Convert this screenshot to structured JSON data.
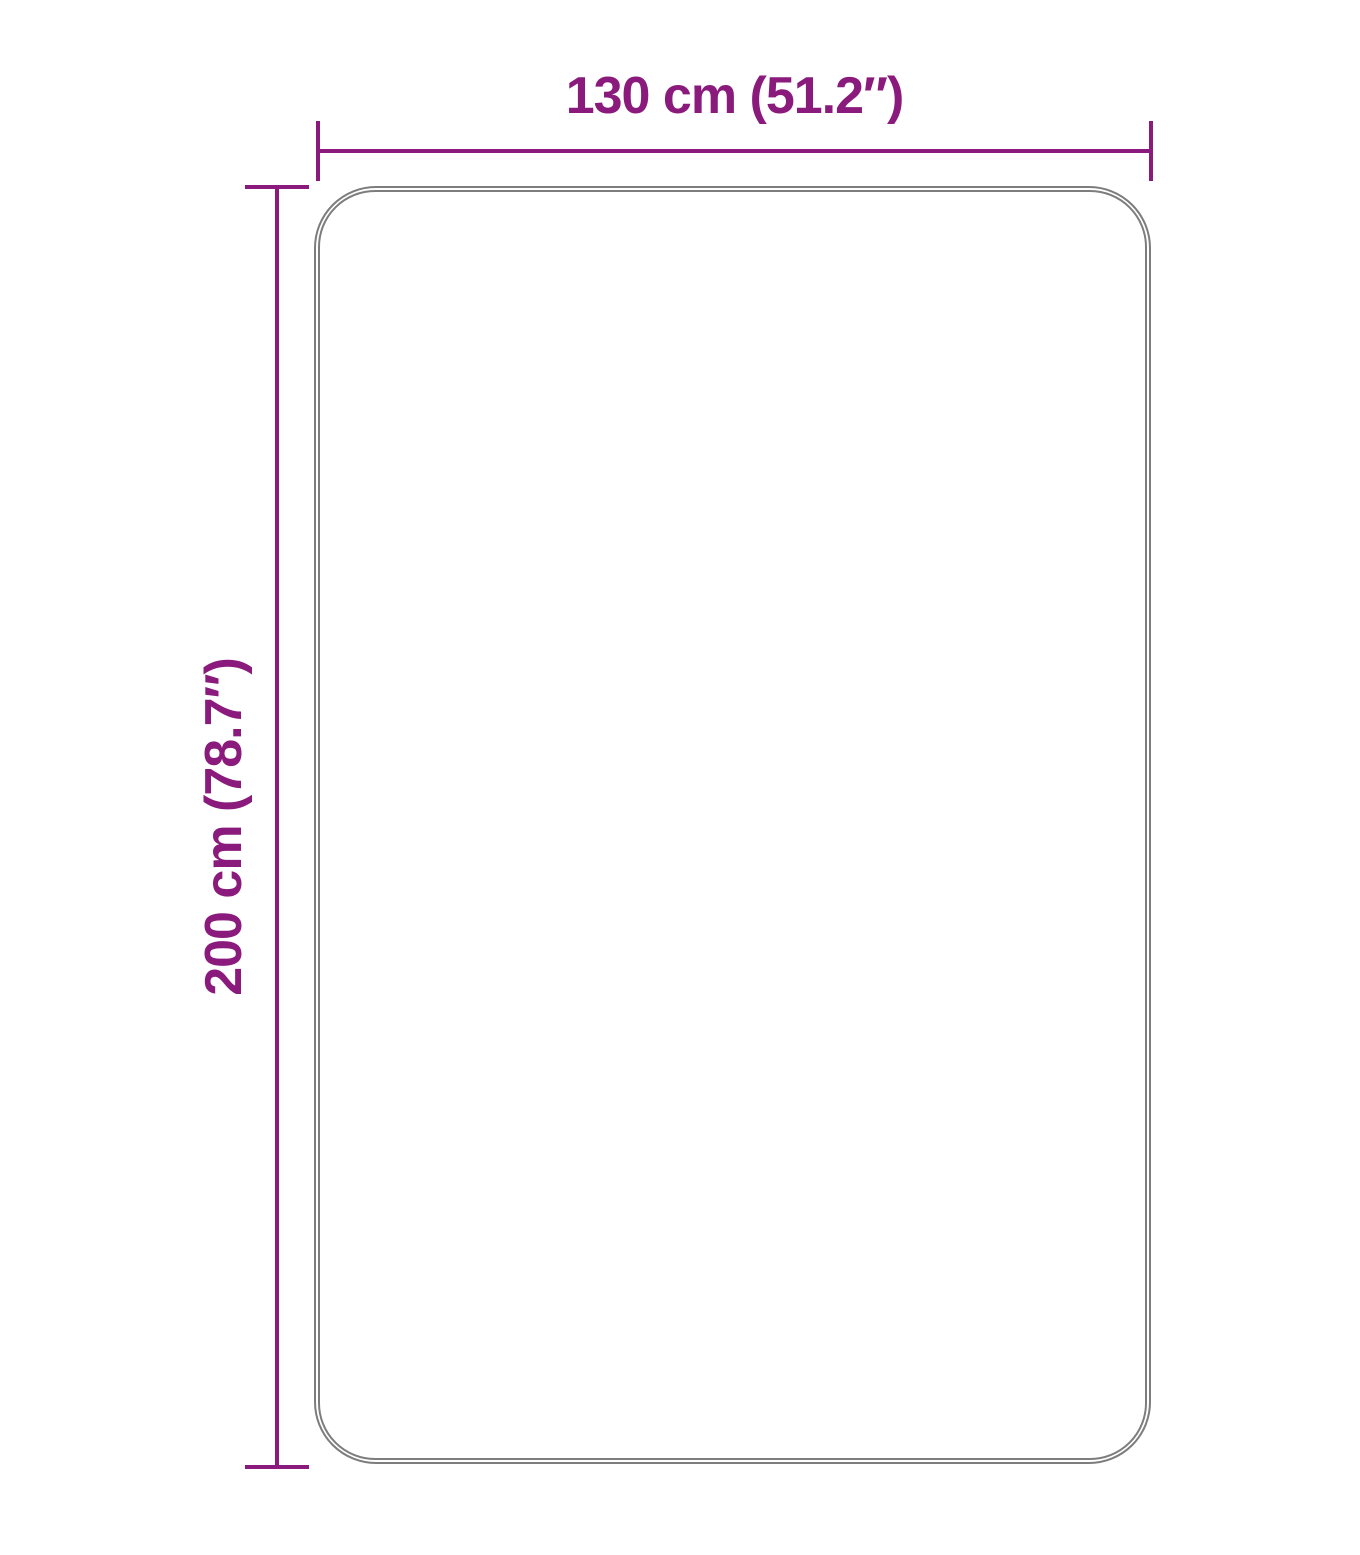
{
  "diagram": {
    "type": "product-dimension-diagram",
    "width_label": "130 cm (51.2″)",
    "height_label": "200 cm (78.7″)"
  },
  "colors": {
    "dimension": "#8A1B7C",
    "outline": "#7D7D7D",
    "background": "#FFFFFF"
  }
}
